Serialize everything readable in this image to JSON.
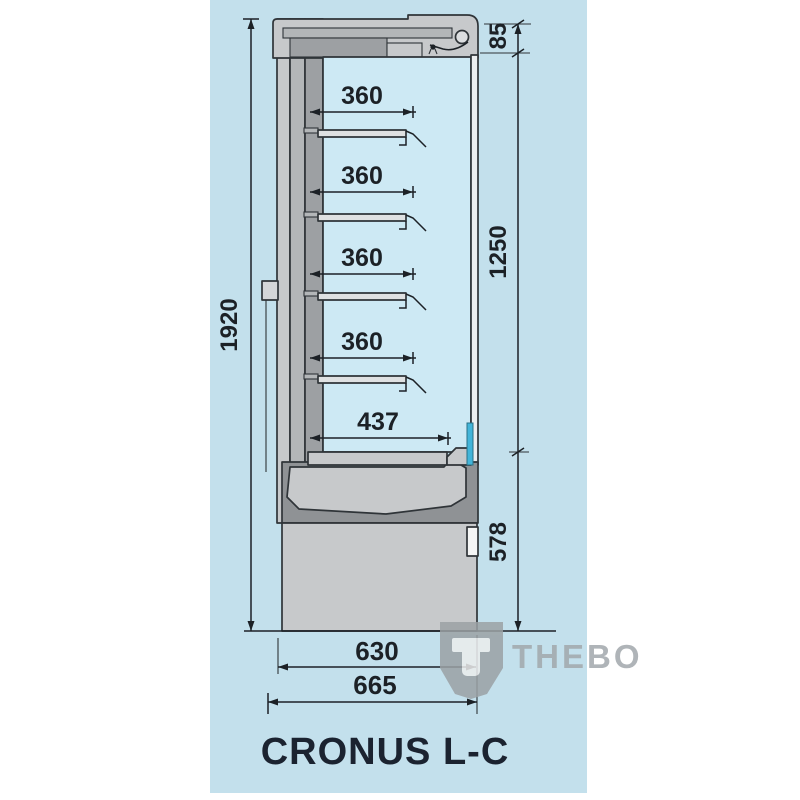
{
  "panel": {
    "background": "#c3e0ec"
  },
  "labels": {
    "total_height": "1920",
    "top_section": "85",
    "glass_section": "1250",
    "base_section": "578",
    "shelf_depth_1": "360",
    "shelf_depth_2": "360",
    "shelf_depth_3": "360",
    "shelf_depth_4": "360",
    "bottom_shelf_depth": "437",
    "base_depth": "630",
    "total_depth": "665",
    "model_name": "CRONUS L-C",
    "brand": "THEBO"
  },
  "colors": {
    "outline": "#2f3438",
    "case_light": "#c7c9cb",
    "case_medium": "#b3b6b8",
    "case_dark": "#9da0a3",
    "base_dark": "#8f9295",
    "interior": "#cde9f4",
    "door_accent": "#43b5d9",
    "dimension_text": "#1c2126",
    "title_text": "#1b2330",
    "watermark_gray": "#a2a8ac"
  }
}
